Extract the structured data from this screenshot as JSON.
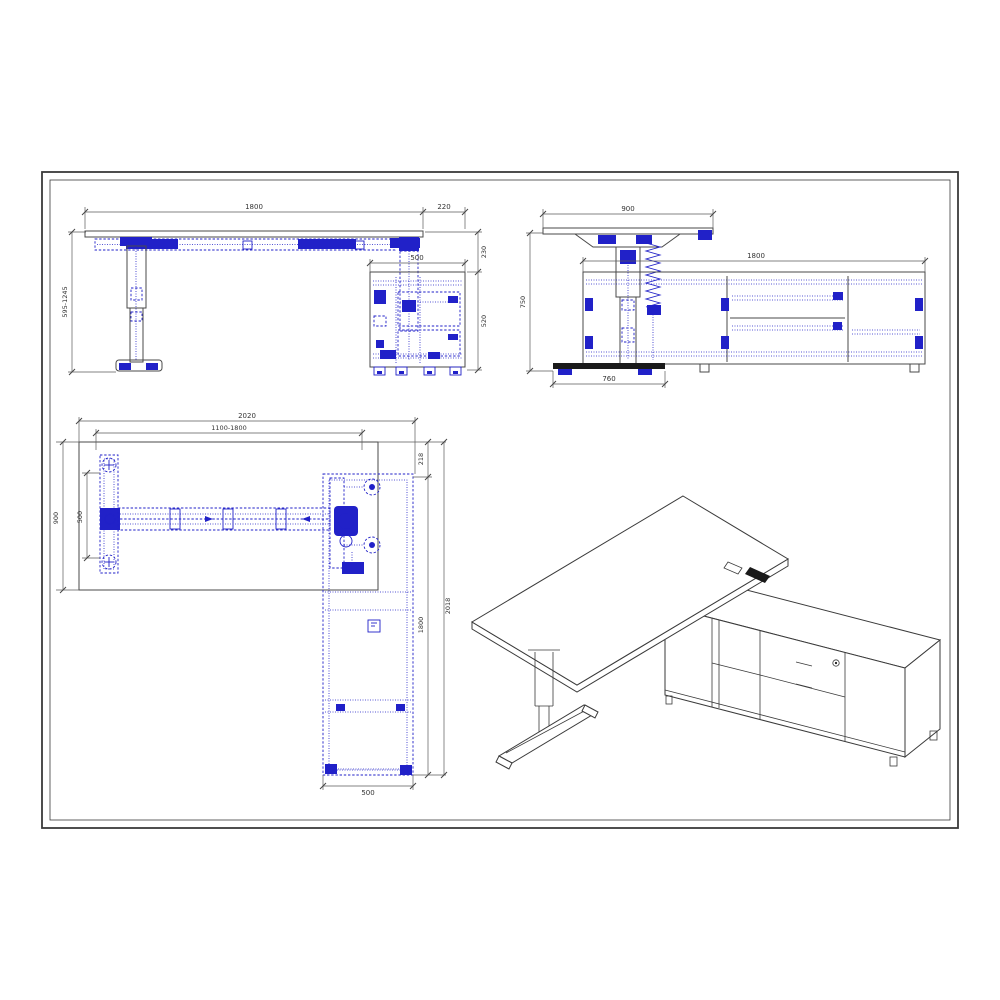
{
  "title": "height-adjustable-desk-with-credenza-technical-drawing",
  "colors": {
    "accent_blue": "#2121c8",
    "line": "#4a4a4a",
    "background": "#ffffff"
  },
  "views": {
    "front": {
      "label": "front-elevation",
      "dim_desk_width": "1800",
      "dim_overhang": "220",
      "dim_cabinet_width": "500",
      "dim_height_range": "595-1245",
      "dim_top_gap": "230",
      "dim_cabinet_height": "520"
    },
    "side": {
      "label": "side-elevation",
      "dim_desk_depth": "900",
      "dim_credenza_length": "1800",
      "dim_total_height": "750",
      "dim_foot_length": "760"
    },
    "plan": {
      "label": "plan-view",
      "dim_overall_width": "2020",
      "dim_frame_range": "1100-1800",
      "dim_desk_depth": "900",
      "dim_foot_span": "500",
      "dim_credenza_offset": "218",
      "dim_credenza_length": "1800",
      "dim_overall_depth": "2018",
      "dim_credenza_width": "500"
    },
    "iso": {
      "label": "isometric-view"
    }
  }
}
